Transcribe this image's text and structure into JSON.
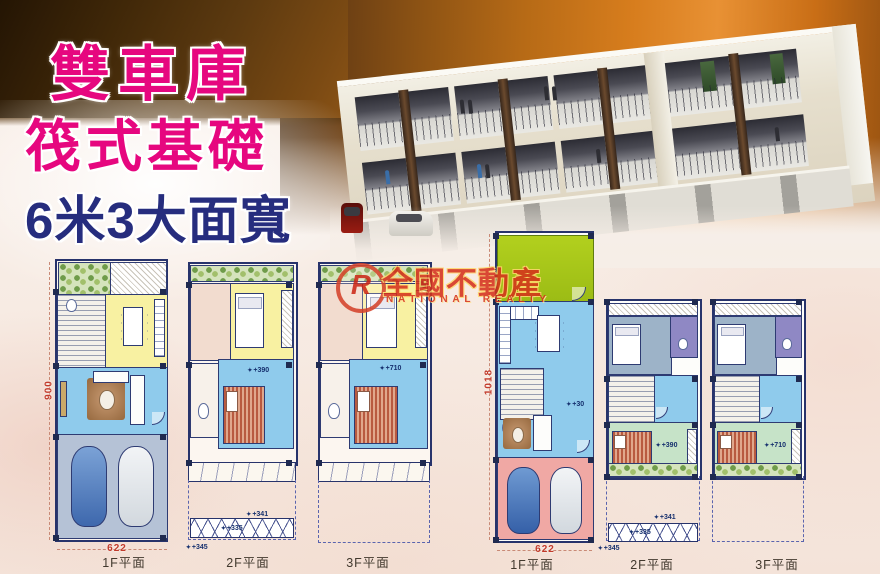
{
  "headline": {
    "line1": "雙車庫",
    "line2": "筏式基礎",
    "line3": "6米3大面寬"
  },
  "watermark": {
    "logo_letter": "R",
    "brand_cn": "全國不動產",
    "brand_en": "NATIONAL REALTY"
  },
  "captions": {
    "f1": "1F平面",
    "f2": "2F平面",
    "f3": "3F平面"
  },
  "dims": {
    "left_height": "900",
    "left_width": "622",
    "right_height": "1018",
    "right_width": "622"
  },
  "levels": {
    "lv2": "+390",
    "lv3": "+710",
    "entry": "+30",
    "a341": "+341",
    "a335": "+335",
    "a345": "+345"
  },
  "icons": {
    "level_marker": "✦"
  },
  "palette": {
    "headline_pink": "#e6077f",
    "headline_navy": "#262d7e",
    "watermark_red": "#d5321c",
    "dim_red": "#c23b2b",
    "wall_navy": "#27336b",
    "room_blue": "#8fcbec",
    "room_yellow": "#f8f1a2",
    "room_green": "#c6e3c8",
    "room_lime": "#a9c71d",
    "garage_pink": "#f0a8a4",
    "garage_gray": "#b5c2d6",
    "bg_orange": "#c96f1c",
    "bg_brown": "#5e3a16"
  }
}
